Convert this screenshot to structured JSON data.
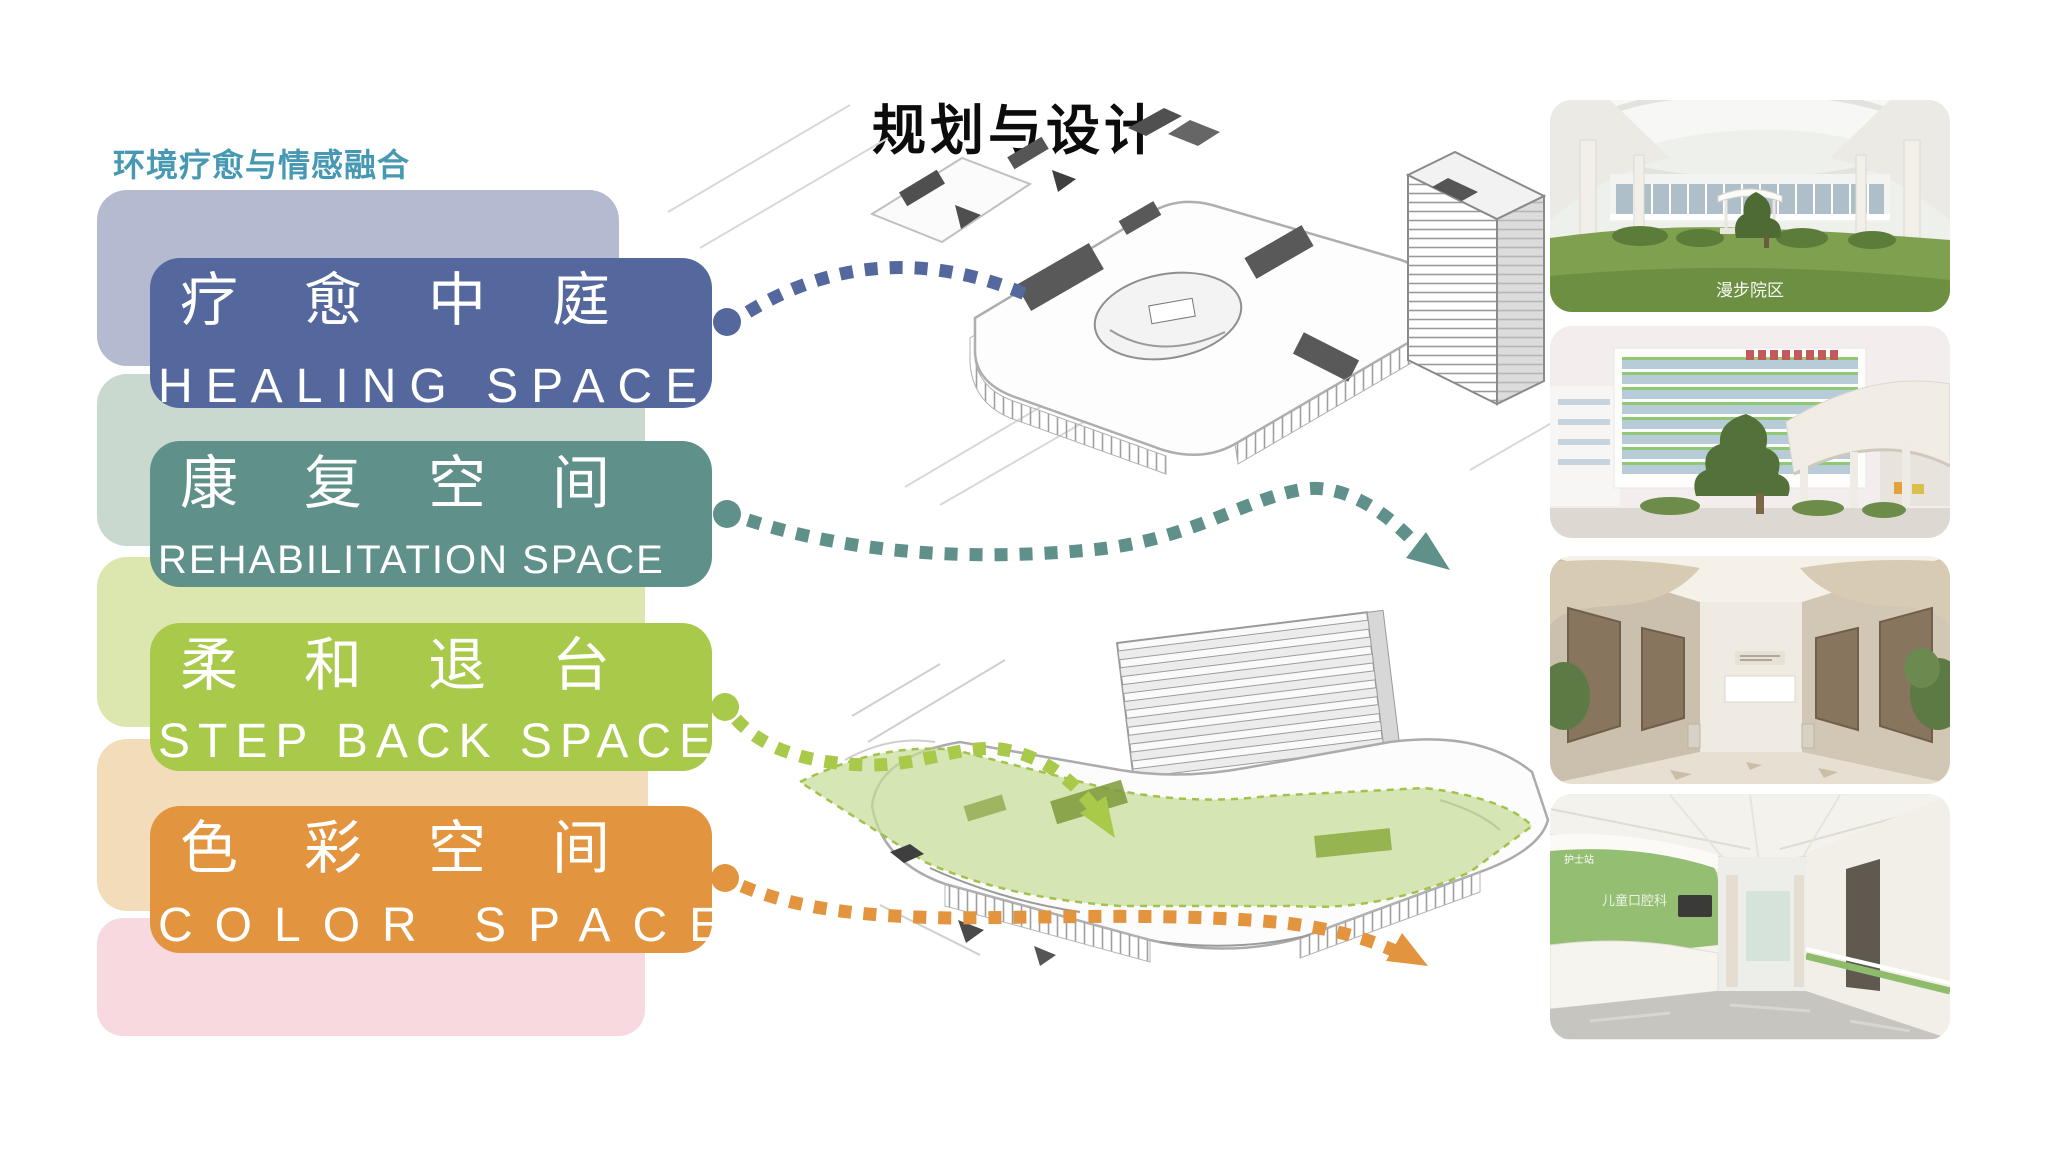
{
  "slide": {
    "title": "规划与设计",
    "left_panel": {
      "heading": "环境疗愈与情感融合",
      "heading_color": "#4799b3",
      "cards": [
        {
          "zh": "疗愈中庭",
          "en": "HEALING SPACE",
          "color": "#55689d",
          "shadow_color": "#b4bbd1"
        },
        {
          "zh": "康复空间",
          "en": "REHABILITATION SPACE",
          "color": "#60908a",
          "shadow_color": "#c9d9d0"
        },
        {
          "zh": "柔和退台",
          "en": "STEP BACK SPACE",
          "color": "#a9c94b",
          "shadow_color": "#dbe7ae"
        },
        {
          "zh": "色彩空间",
          "en": "COLOR SPACE",
          "color": "#e2943e",
          "shadow_color": "#f3dcba"
        }
      ],
      "trailing_shadow_color": "#f8d9e0"
    },
    "connectors": {
      "healing_color": "#55689d",
      "rehabilitation_color": "#60908a",
      "stepback_color": "#a9c94b",
      "colorspace_color": "#e2943e",
      "highlight_overlay_color": "#a2c24b"
    },
    "photos": [
      {
        "caption": "漫步院区"
      },
      {
        "caption": ""
      },
      {
        "caption": ""
      },
      {
        "caption": ""
      }
    ],
    "photo_texts": {
      "nurse_station": "护士站",
      "department": "儿童口腔科"
    }
  }
}
